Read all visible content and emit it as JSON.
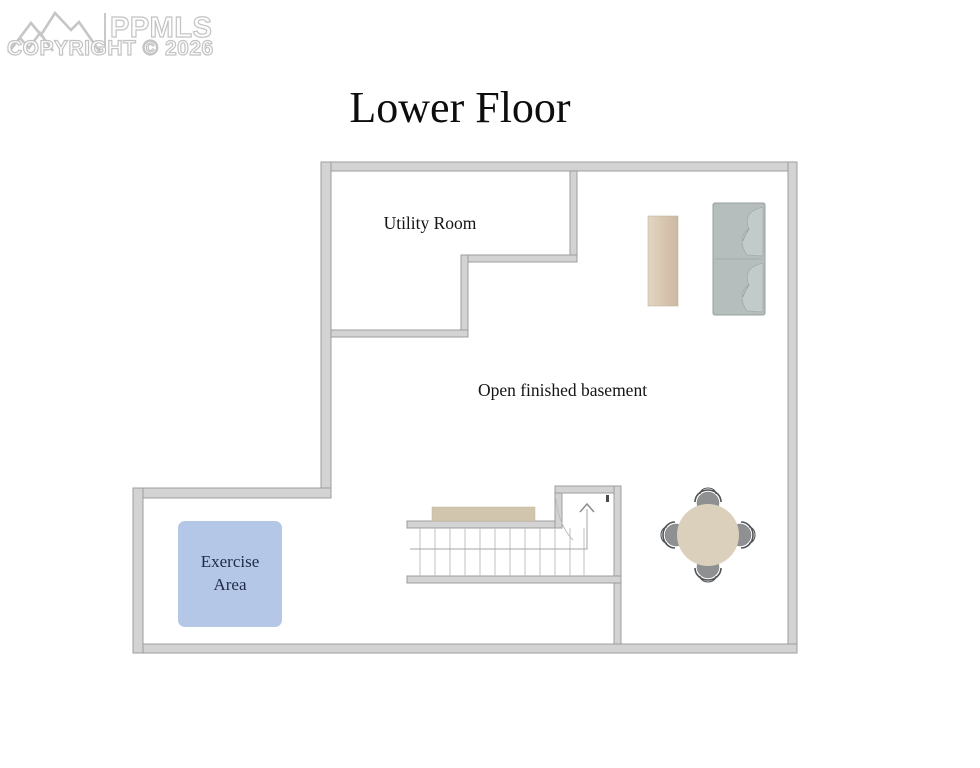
{
  "watermark": {
    "brand": "PPMLS",
    "copyright": "COPYRIGHT © 2026",
    "logo_icon": "mountain-range-icon",
    "color": "#c6c6c6"
  },
  "title": "Lower Floor",
  "labels": {
    "utility_room": "Utility Room",
    "basement": "Open finished basement",
    "exercise_line1": "Exercise",
    "exercise_line2": "Area"
  },
  "colors": {
    "wall_fill": "#d3d3d3",
    "wall_edge": "#9c9c9c",
    "exercise_fill": "#b5c7e7",
    "exercise_text": "#1e2a46",
    "sofa_fill": "#b5bdbd",
    "console_table_fill": "#d9c7b2",
    "stair_ledge_fill": "#d2c5ae",
    "dining_table_fill": "#dbd0bb",
    "chair_fill": "#8e9092"
  },
  "furniture": {
    "sofa": "sofa-icon",
    "console_table": "console-table-icon",
    "dining_table": "round-dining-table-icon",
    "dining_chairs": 4,
    "stairs": "staircase-up-icon",
    "exercise_mat": "exercise-area-mat"
  }
}
